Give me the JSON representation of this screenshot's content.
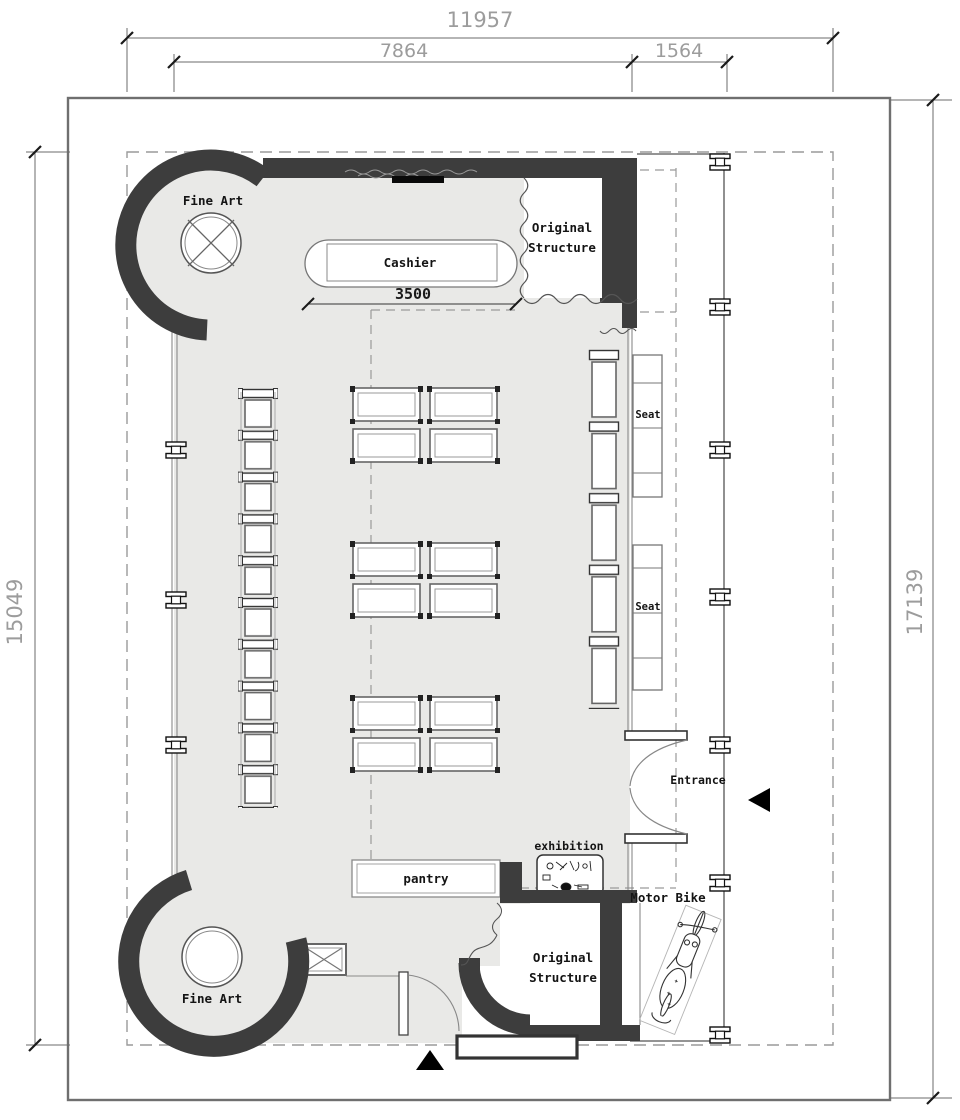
{
  "dimensions": {
    "overall_width": "11957",
    "main_width": "7864",
    "side_width": "1564",
    "left_height": "15049",
    "right_height": "17139",
    "cashier_width": "3500"
  },
  "rooms": {
    "fine_art_top": "Fine Art",
    "fine_art_bottom": "Fine Art",
    "cashier": "Cashier",
    "original_structure_top_line1": "Original",
    "original_structure_top_line2": "Structure",
    "original_structure_bottom_line1": "Original",
    "original_structure_bottom_line2": "Structure",
    "seat_upper": "Seat",
    "seat_lower": "Seat",
    "entrance": "Entrance",
    "exhibition": "exhibition",
    "pantry": "pantry",
    "motor_bike": "Motor Bike"
  },
  "colors": {
    "wall": "#3d3d3d",
    "floor": "#e9e9e7",
    "outline": "#6f6f6f",
    "dimension_text": "#9c9c9c",
    "label_text": "#141414"
  }
}
